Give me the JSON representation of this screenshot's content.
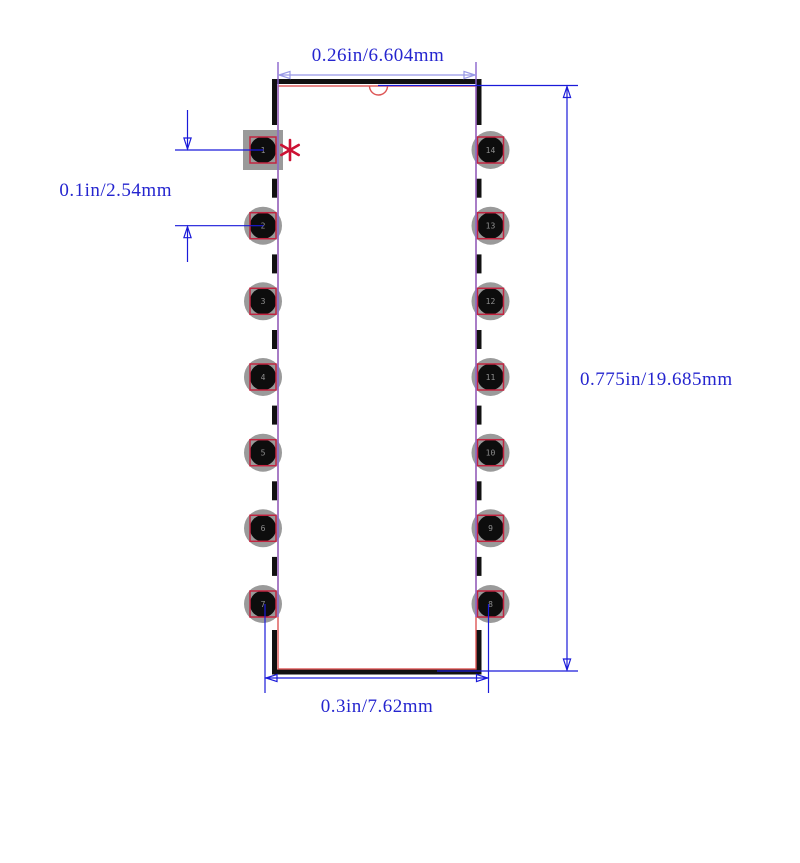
{
  "drawing": {
    "type": "pcb-footprint-dip14",
    "dimensions": {
      "top": {
        "label": "0.26in/6.604mm"
      },
      "left": {
        "label": "0.1in/2.54mm"
      },
      "right": {
        "label": "0.775in/19.685mm"
      },
      "bottom": {
        "label": "0.3in/7.62mm"
      }
    },
    "markers": {
      "pin1_asterisk": "*",
      "orientation_notch": "top-center-semicircle"
    },
    "colors": {
      "dimension_text_blue": "#2525cf",
      "dimension_line_blue": "#1a1ad9",
      "dimension_line_lavender": "#9898e6",
      "extension_line_violet": "#8a63cc",
      "body_outline_black": "#111111",
      "body_outline_red": "#dd5555",
      "pad_ring_gray": "#9a9a9a",
      "pad_hole_black": "#0d0d0d",
      "pad_outline_red": "#c22440",
      "pin1_marker_red": "#cc1133"
    }
  },
  "pads": [
    {
      "n": "1"
    },
    {
      "n": "2"
    },
    {
      "n": "3"
    },
    {
      "n": "4"
    },
    {
      "n": "5"
    },
    {
      "n": "6"
    },
    {
      "n": "7"
    },
    {
      "n": "14"
    },
    {
      "n": "13"
    },
    {
      "n": "12"
    },
    {
      "n": "11"
    },
    {
      "n": "10"
    },
    {
      "n": "9"
    },
    {
      "n": "8"
    }
  ]
}
